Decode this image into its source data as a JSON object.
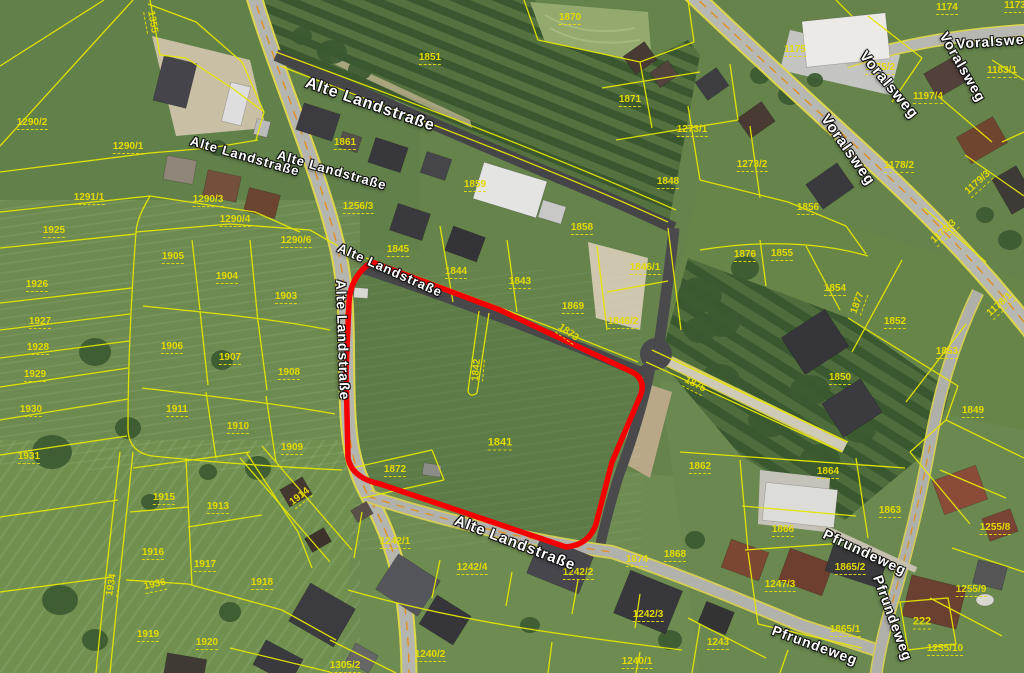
{
  "map": {
    "type": "aerial-cadastral-map",
    "selected_parcel": "1841",
    "colors": {
      "parcel_line": "#e6e600",
      "parcel_label": "#e4da00",
      "street_label": "#ffffff",
      "highlight_outline": "#f50000"
    },
    "street_labels": [
      {
        "t": "Alte Landstraße",
        "x": 370,
        "y": 105,
        "r": 19,
        "s": 16
      },
      {
        "t": "Alte Landstraße",
        "x": 245,
        "y": 156,
        "r": 16,
        "s": 13
      },
      {
        "t": "Alte Landstraße",
        "x": 332,
        "y": 170,
        "r": 16,
        "s": 13
      },
      {
        "t": "Alte Landstraße",
        "x": 390,
        "y": 270,
        "r": 24,
        "s": 13
      },
      {
        "t": "Alte Landstraße",
        "x": 343,
        "y": 340,
        "r": 88,
        "s": 14
      },
      {
        "t": "Alte Landstraße",
        "x": 515,
        "y": 543,
        "r": 21,
        "s": 15
      },
      {
        "t": "Voralsweg",
        "x": 995,
        "y": 41,
        "r": -4,
        "s": 14
      },
      {
        "t": "Voralsweg",
        "x": 963,
        "y": 67,
        "r": 60,
        "s": 14
      },
      {
        "t": "Voralsweg",
        "x": 889,
        "y": 85,
        "r": 50,
        "s": 15
      },
      {
        "t": "Voralsweg",
        "x": 848,
        "y": 150,
        "r": 55,
        "s": 15
      },
      {
        "t": "Pfrundeweg",
        "x": 865,
        "y": 552,
        "r": 25,
        "s": 14
      },
      {
        "t": "Pfrundeweg",
        "x": 893,
        "y": 618,
        "r": 70,
        "s": 14
      },
      {
        "t": "Pfrundeweg",
        "x": 815,
        "y": 645,
        "r": 20,
        "s": 14
      }
    ],
    "parcel_labels": [
      {
        "t": "1355",
        "x": 152,
        "y": 22,
        "r": 80
      },
      {
        "t": "1290/2",
        "x": 32,
        "y": 123
      },
      {
        "t": "1290/1",
        "x": 128,
        "y": 147
      },
      {
        "t": "1291/1",
        "x": 89,
        "y": 198
      },
      {
        "t": "1290/3",
        "x": 208,
        "y": 200
      },
      {
        "t": "1290/4",
        "x": 235,
        "y": 220
      },
      {
        "t": "1290/6",
        "x": 296,
        "y": 241
      },
      {
        "t": "1256/3",
        "x": 358,
        "y": 207
      },
      {
        "t": "1925",
        "x": 54,
        "y": 231
      },
      {
        "t": "1926",
        "x": 37,
        "y": 285
      },
      {
        "t": "1927",
        "x": 40,
        "y": 322
      },
      {
        "t": "1928",
        "x": 38,
        "y": 348
      },
      {
        "t": "1929",
        "x": 35,
        "y": 375
      },
      {
        "t": "1930",
        "x": 31,
        "y": 410
      },
      {
        "t": "1931",
        "x": 29,
        "y": 457
      },
      {
        "t": "1905",
        "x": 173,
        "y": 257
      },
      {
        "t": "1904",
        "x": 227,
        "y": 277
      },
      {
        "t": "1903",
        "x": 286,
        "y": 297
      },
      {
        "t": "1906",
        "x": 172,
        "y": 347
      },
      {
        "t": "1907",
        "x": 230,
        "y": 358
      },
      {
        "t": "1908",
        "x": 289,
        "y": 373
      },
      {
        "t": "1911",
        "x": 177,
        "y": 410
      },
      {
        "t": "1910",
        "x": 238,
        "y": 427
      },
      {
        "t": "1909",
        "x": 292,
        "y": 448
      },
      {
        "t": "1915",
        "x": 164,
        "y": 498
      },
      {
        "t": "1913",
        "x": 218,
        "y": 507
      },
      {
        "t": "1914",
        "x": 300,
        "y": 497,
        "r": -38
      },
      {
        "t": "1916",
        "x": 153,
        "y": 553
      },
      {
        "t": "1917",
        "x": 205,
        "y": 565
      },
      {
        "t": "1918",
        "x": 262,
        "y": 583
      },
      {
        "t": "1934",
        "x": 112,
        "y": 585,
        "r": -80
      },
      {
        "t": "1936",
        "x": 155,
        "y": 585,
        "r": -12
      },
      {
        "t": "1919",
        "x": 148,
        "y": 635
      },
      {
        "t": "1920",
        "x": 207,
        "y": 643
      },
      {
        "t": "1851",
        "x": 430,
        "y": 58
      },
      {
        "t": "1870",
        "x": 570,
        "y": 18
      },
      {
        "t": "1871",
        "x": 630,
        "y": 100
      },
      {
        "t": "1861",
        "x": 345,
        "y": 143
      },
      {
        "t": "1859",
        "x": 475,
        "y": 185
      },
      {
        "t": "1858",
        "x": 582,
        "y": 228
      },
      {
        "t": "1845",
        "x": 398,
        "y": 250
      },
      {
        "t": "1844",
        "x": 456,
        "y": 272
      },
      {
        "t": "1843",
        "x": 520,
        "y": 282
      },
      {
        "t": "1869",
        "x": 573,
        "y": 307
      },
      {
        "t": "1846/1",
        "x": 645,
        "y": 268
      },
      {
        "t": "1846/2",
        "x": 623,
        "y": 322
      },
      {
        "t": "1873",
        "x": 568,
        "y": 333,
        "r": 35
      },
      {
        "t": "1842",
        "x": 477,
        "y": 370,
        "r": -85
      },
      {
        "t": "1841",
        "x": 500,
        "y": 443,
        "s": 11
      },
      {
        "t": "1872",
        "x": 395,
        "y": 470
      },
      {
        "t": "1848",
        "x": 668,
        "y": 182
      },
      {
        "t": "1273/1",
        "x": 692,
        "y": 130
      },
      {
        "t": "1273/2",
        "x": 752,
        "y": 165
      },
      {
        "t": "1856",
        "x": 808,
        "y": 208
      },
      {
        "t": "1876",
        "x": 745,
        "y": 255
      },
      {
        "t": "1855",
        "x": 782,
        "y": 254
      },
      {
        "t": "1854",
        "x": 835,
        "y": 289
      },
      {
        "t": "1852",
        "x": 895,
        "y": 322
      },
      {
        "t": "1853",
        "x": 947,
        "y": 352
      },
      {
        "t": "1850",
        "x": 840,
        "y": 378
      },
      {
        "t": "1849",
        "x": 973,
        "y": 411
      },
      {
        "t": "1875",
        "x": 695,
        "y": 385,
        "r": 27
      },
      {
        "t": "1877",
        "x": 858,
        "y": 303,
        "r": -70
      },
      {
        "t": "1174",
        "x": 947,
        "y": 8
      },
      {
        "t": "1173",
        "x": 1015,
        "y": 6
      },
      {
        "t": "1175",
        "x": 795,
        "y": 50
      },
      {
        "t": "1175/2",
        "x": 880,
        "y": 68
      },
      {
        "t": "1183/1",
        "x": 1002,
        "y": 71
      },
      {
        "t": "1197/4",
        "x": 928,
        "y": 97
      },
      {
        "t": "1178/2",
        "x": 899,
        "y": 166
      },
      {
        "t": "1179/3",
        "x": 978,
        "y": 183,
        "r": -42
      },
      {
        "t": "1178/3",
        "x": 944,
        "y": 232,
        "r": -42
      },
      {
        "t": "1178/1",
        "x": 1000,
        "y": 305,
        "r": -42
      },
      {
        "t": "1862",
        "x": 700,
        "y": 467
      },
      {
        "t": "1864",
        "x": 828,
        "y": 472
      },
      {
        "t": "1863",
        "x": 890,
        "y": 511
      },
      {
        "t": "1866",
        "x": 783,
        "y": 530
      },
      {
        "t": "1865/2",
        "x": 850,
        "y": 568
      },
      {
        "t": "1865/1",
        "x": 845,
        "y": 630
      },
      {
        "t": "1247/3",
        "x": 780,
        "y": 585
      },
      {
        "t": "222",
        "x": 922,
        "y": 622,
        "s": 11
      },
      {
        "t": "1243",
        "x": 718,
        "y": 643
      },
      {
        "t": "1255/8",
        "x": 995,
        "y": 528
      },
      {
        "t": "1255/9",
        "x": 971,
        "y": 590
      },
      {
        "t": "1255/10",
        "x": 945,
        "y": 649
      },
      {
        "t": "1242/1",
        "x": 395,
        "y": 542
      },
      {
        "t": "1242/4",
        "x": 472,
        "y": 568
      },
      {
        "t": "1242/2",
        "x": 578,
        "y": 573
      },
      {
        "t": "1242/3",
        "x": 648,
        "y": 615
      },
      {
        "t": "1874",
        "x": 637,
        "y": 560
      },
      {
        "t": "1868",
        "x": 675,
        "y": 555
      },
      {
        "t": "1240/2",
        "x": 430,
        "y": 655
      },
      {
        "t": "1240/1",
        "x": 637,
        "y": 662
      },
      {
        "t": "1305/2",
        "x": 345,
        "y": 666
      }
    ]
  }
}
